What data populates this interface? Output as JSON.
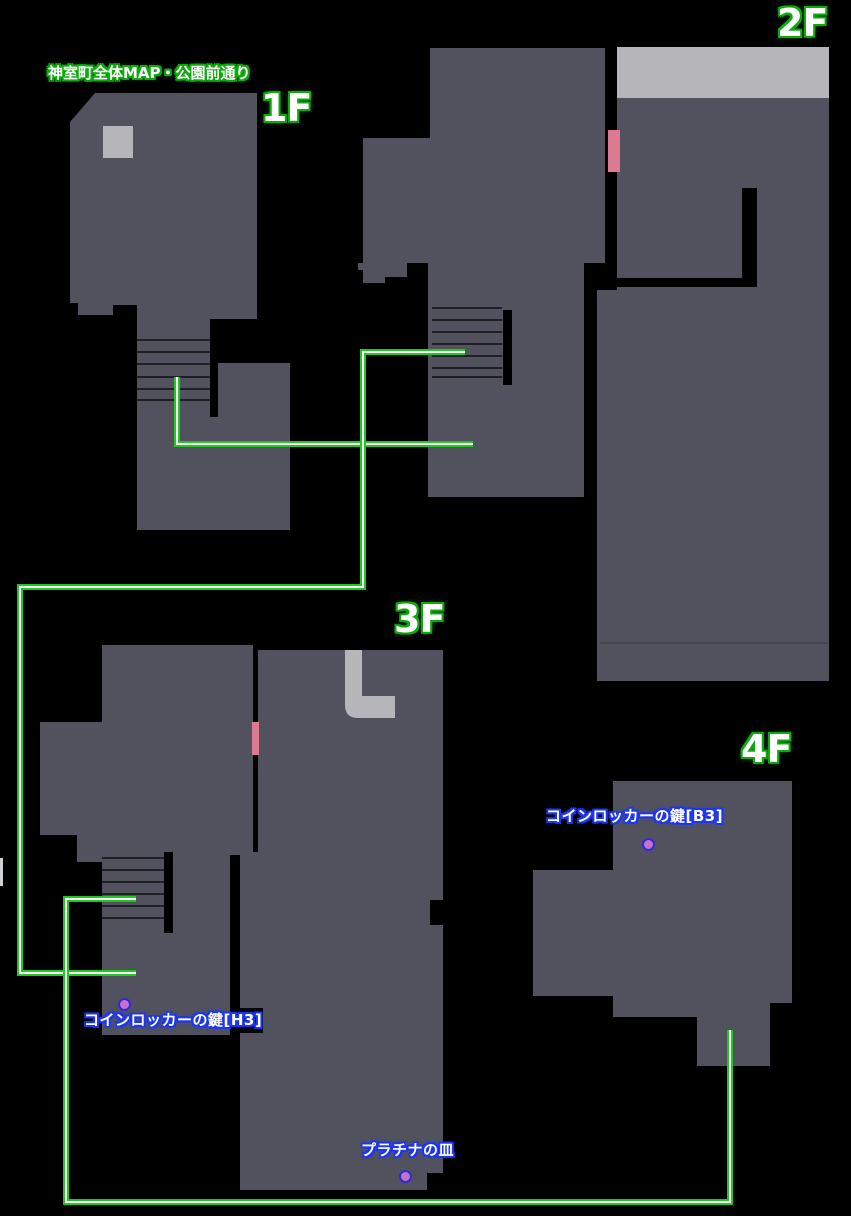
{
  "title": "神室町全体MAP・公園前通り",
  "floors": {
    "f1": "1F",
    "f2": "2F",
    "f3": "3F",
    "f4": "4F"
  },
  "items": {
    "b3": "コインロッカーの鍵[B3]",
    "h3": "コインロッカーの鍵[H3]",
    "plate": "プラチナの皿"
  },
  "colors": {
    "background": "#000000",
    "floor_fill": "#51525e",
    "light_area": "#b6b6ba",
    "route_green": "#1fc91f",
    "door_pink": "#dd7a93",
    "item_dot": "#ca6ecb",
    "item_dot_border": "#2d2dd5",
    "outline_green": "#0da90d",
    "outline_blue": "#1d36ee"
  }
}
